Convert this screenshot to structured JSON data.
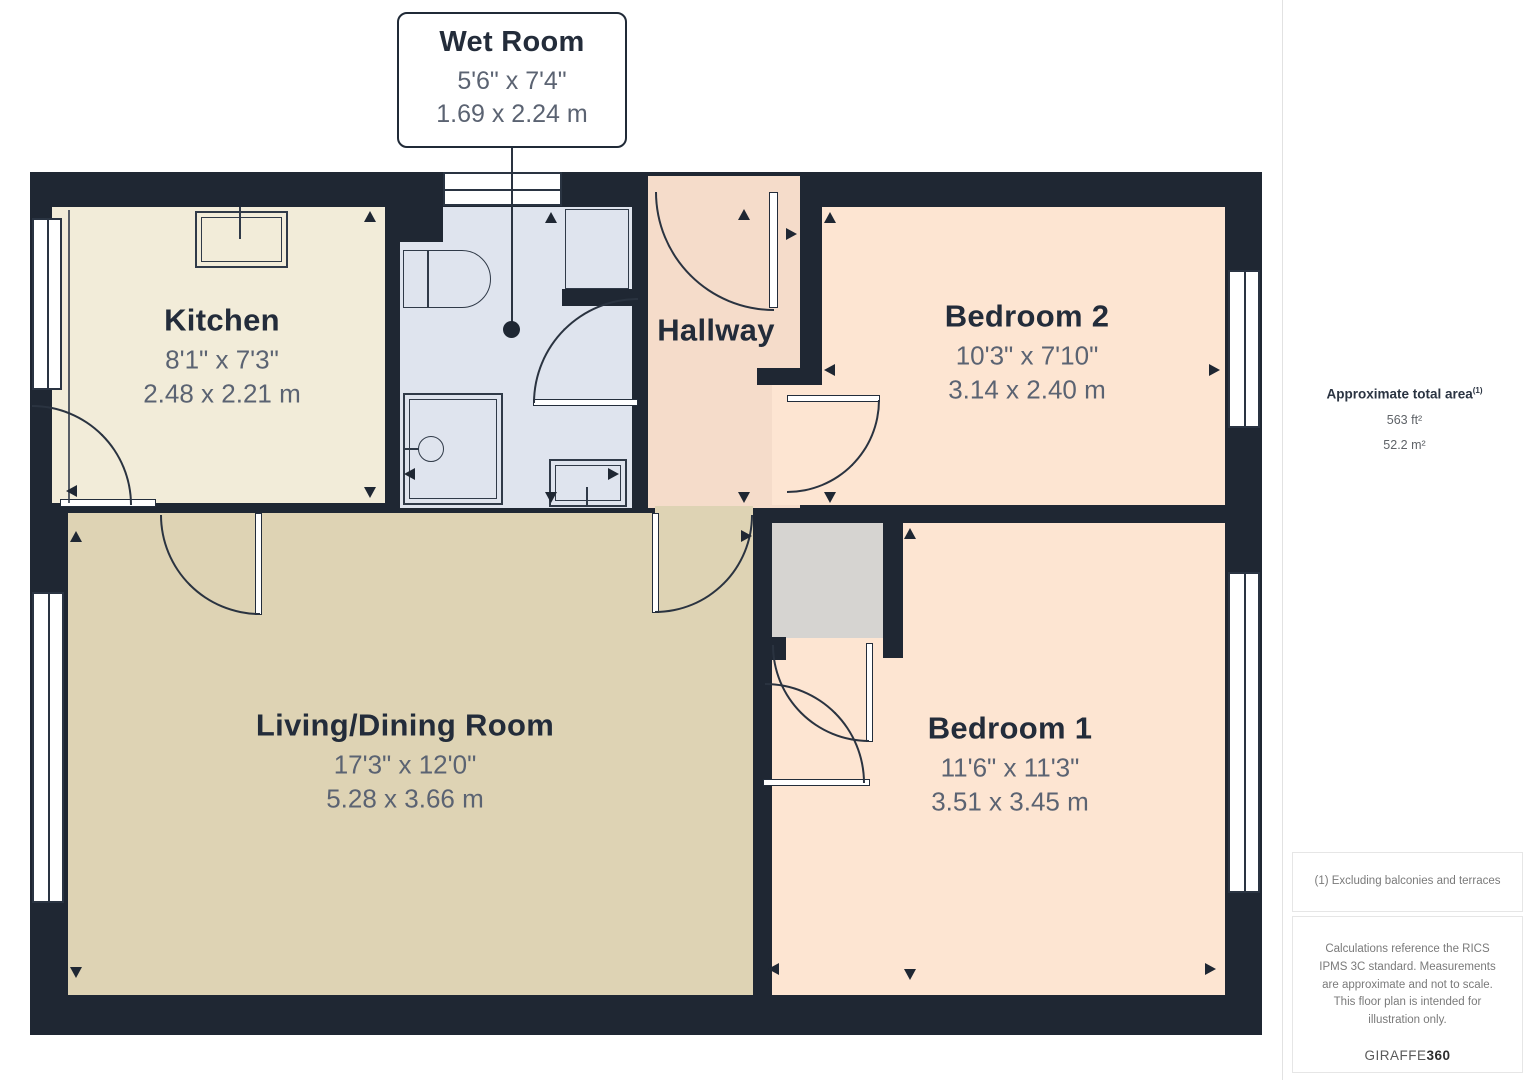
{
  "callout": {
    "title": "Wet Room",
    "imperial": "5'6\" x 7'4\"",
    "metric": "1.69 x 2.24 m"
  },
  "rooms": {
    "kitchen": {
      "name": "Kitchen",
      "imperial": "8'1\" x 7'3\"",
      "metric": "2.48 x 2.21 m"
    },
    "hallway": {
      "name": "Hallway"
    },
    "bedroom2": {
      "name": "Bedroom 2",
      "imperial": "10'3\" x 7'10\"",
      "metric": "3.14 x 2.40 m"
    },
    "living": {
      "name": "Living/Dining Room",
      "imperial": "17'3\" x 12'0\"",
      "metric": "5.28 x 3.66 m"
    },
    "bedroom1": {
      "name": "Bedroom 1",
      "imperial": "11'6\" x 11'3\"",
      "metric": "3.51 x 3.45 m"
    }
  },
  "sidebar": {
    "area_title": "Approximate total area",
    "area_superscript": "(1)",
    "area_ft": "563 ft²",
    "area_m": "52.2 m²",
    "footnote": "(1) Excluding balconies and terraces",
    "disclaimer": "Calculations reference the RICS IPMS 3C standard. Measurements are approximate and not to scale. This floor plan is intended for illustration only.",
    "brand_name": "GIRAFFE",
    "brand_suffix": "360"
  },
  "colors": {
    "wall": "#1f2733",
    "kitchen_floor": "#f2ecd9",
    "wetroom_floor": "#dfe4ee",
    "hallway_floor": "#f5dcca",
    "bedroom_floor": "#fde5d2",
    "living_floor": "#ded3b4",
    "fixture_gray": "#d6d4d1"
  }
}
